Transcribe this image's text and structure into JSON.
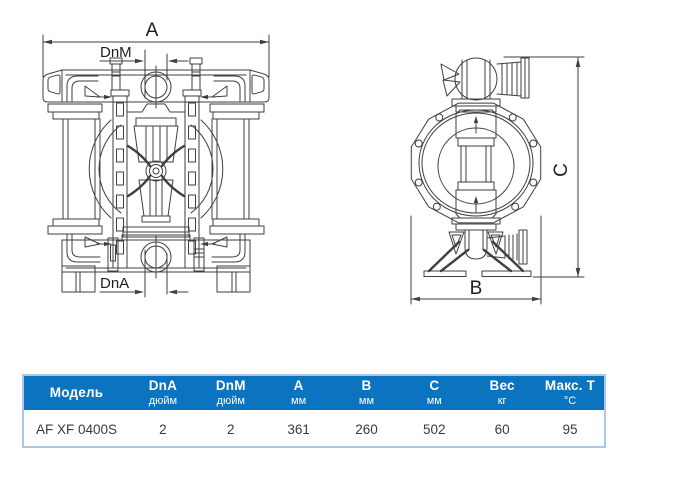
{
  "diagram": {
    "front_view": {
      "label_a": "A",
      "label_dnm": "DnM",
      "label_dna": "DnA"
    },
    "side_view": {
      "label_b": "B",
      "label_c": "C"
    }
  },
  "table": {
    "columns": [
      {
        "label": "Модель",
        "unit": ""
      },
      {
        "label": "DnA",
        "unit": "дюйм"
      },
      {
        "label": "DnM",
        "unit": "дюйм"
      },
      {
        "label": "A",
        "unit": "мм"
      },
      {
        "label": "B",
        "unit": "мм"
      },
      {
        "label": "C",
        "unit": "мм"
      },
      {
        "label": "Вес",
        "unit": "кг"
      },
      {
        "label": "Макс. T",
        "unit": "°C"
      }
    ],
    "rows": [
      {
        "model": "AF XF 0400S",
        "dna_inch": "2",
        "dnm_inch": "2",
        "a_mm": "361",
        "b_mm": "260",
        "c_mm": "502",
        "weight_kg": "60",
        "max_t_c": "95"
      }
    ]
  },
  "colors": {
    "header_bg": "#0b74c0",
    "table_border": "#aac8e8",
    "line_color": "#3f3f3f"
  }
}
